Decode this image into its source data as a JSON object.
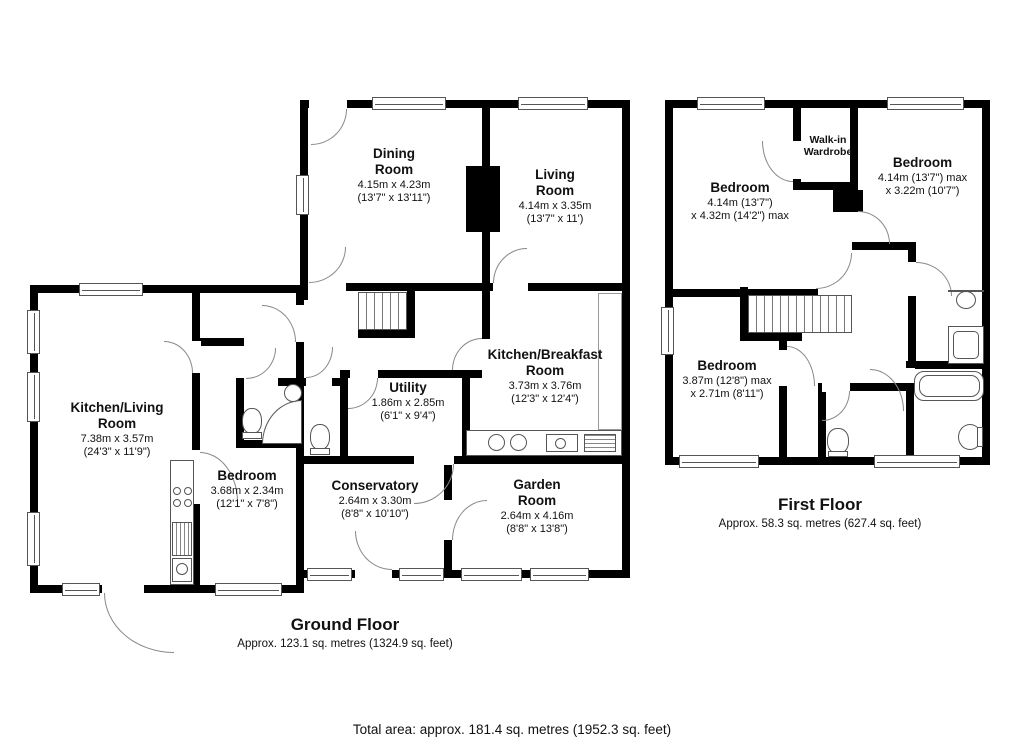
{
  "ground_floor": {
    "title": "Ground Floor",
    "area": "Approx. 123.1 sq. metres (1324.9 sq. feet)",
    "rooms": {
      "dining": {
        "name": "Dining\nRoom",
        "dims": "4.15m x 4.23m\n(13'7\" x 13'11\")"
      },
      "living": {
        "name": "Living\nRoom",
        "dims": "4.14m x 3.35m\n(13'7\" x 11')"
      },
      "kitchen_breakfast": {
        "name": "Kitchen/Breakfast\nRoom",
        "dims": "3.73m x 3.76m\n(12'3\" x 12'4\")"
      },
      "utility": {
        "name": "Utility",
        "dims": "1.86m x 2.85m\n(6'1\" x 9'4\")"
      },
      "kitchen_living": {
        "name": "Kitchen/Living\nRoom",
        "dims": "7.38m x 3.57m\n(24'3\" x 11'9\")"
      },
      "bedroom": {
        "name": "Bedroom",
        "dims": "3.68m x 2.34m\n(12'1\" x 7'8\")"
      },
      "conservatory": {
        "name": "Conservatory",
        "dims": "2.64m x 3.30m\n(8'8\" x 10'10\")"
      },
      "garden": {
        "name": "Garden\nRoom",
        "dims": "2.64m x 4.16m\n(8'8\" x 13'8\")"
      }
    }
  },
  "first_floor": {
    "title": "First Floor",
    "area": "Approx. 58.3 sq. metres (627.4 sq. feet)",
    "rooms": {
      "bedroom_left": {
        "name": "Bedroom",
        "dims": "4.14m (13'7\")\nx 4.32m (14'2\") max"
      },
      "bedroom_right": {
        "name": "Bedroom",
        "dims": "4.14m (13'7\") max\nx 3.22m (10'7\")"
      },
      "bedroom_lower": {
        "name": "Bedroom",
        "dims": "3.87m (12'8\") max\nx 2.71m (8'11\")"
      },
      "wardrobe": {
        "name": "Walk-in\nWardrobe"
      }
    }
  },
  "footer": {
    "total": "Total area: approx. 181.4 sq. metres (1952.3 sq. feet)"
  },
  "colors": {
    "wall": "#000000",
    "line": "#555555",
    "arc": "#888888"
  }
}
